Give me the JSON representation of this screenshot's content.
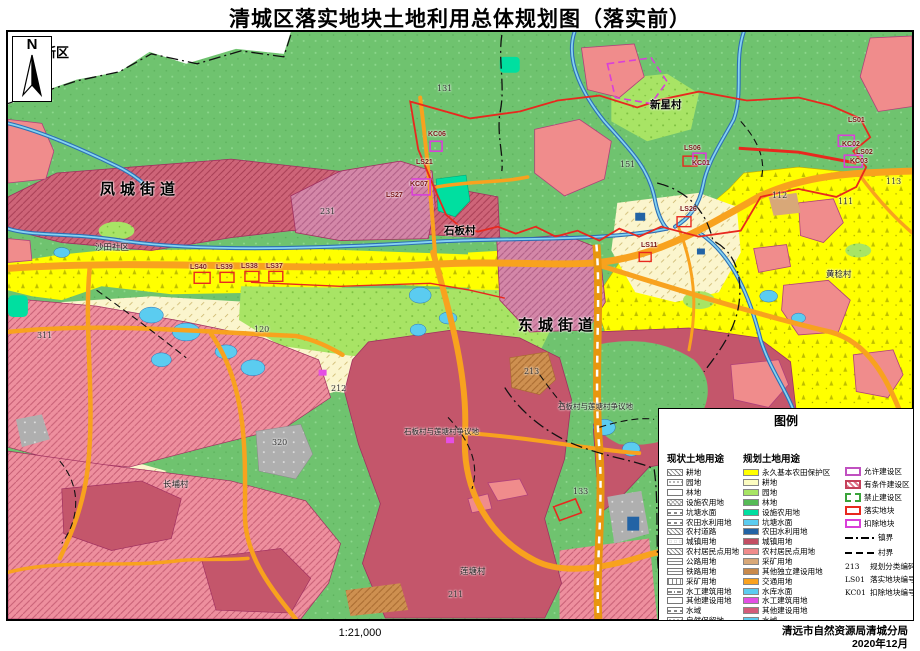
{
  "title": "清城区落实地块土地利用总体规划图（落实前）",
  "north_label": "N",
  "map": {
    "region_labels": [
      {
        "text": "清新区",
        "x": 30,
        "y": 42,
        "kind": "lbl-district"
      },
      {
        "text": "凤城街道",
        "x": 100,
        "y": 178,
        "kind": "lbl-street"
      },
      {
        "text": "东城街道",
        "x": 518,
        "y": 314,
        "kind": "lbl-street"
      },
      {
        "text": "新星村",
        "x": 650,
        "y": 97,
        "kind": "lbl-village"
      },
      {
        "text": "石板村",
        "x": 444,
        "y": 223,
        "kind": "lbl-village"
      },
      {
        "text": "沙田社区",
        "x": 95,
        "y": 241,
        "kind": "lbl-small"
      },
      {
        "text": "黄稔村",
        "x": 826,
        "y": 268,
        "kind": "lbl-small"
      },
      {
        "text": "长埔村",
        "x": 163,
        "y": 478,
        "kind": "lbl-small"
      },
      {
        "text": "莲塘村",
        "x": 460,
        "y": 565,
        "kind": "lbl-small"
      },
      {
        "text": "石板村与莲塘村争议地",
        "x": 404,
        "y": 426,
        "kind": "lbl-tiny"
      },
      {
        "text": "石板村与莲塘村争议地",
        "x": 558,
        "y": 401,
        "kind": "lbl-tiny"
      }
    ],
    "code_labels": [
      {
        "text": "131",
        "x": 437,
        "y": 84,
        "kind": "lbl-code"
      },
      {
        "text": "231",
        "x": 320,
        "y": 207,
        "kind": "lbl-code"
      },
      {
        "text": "151",
        "x": 620,
        "y": 160,
        "kind": "lbl-code"
      },
      {
        "text": "113",
        "x": 886,
        "y": 177,
        "kind": "lbl-code"
      },
      {
        "text": "112",
        "x": 772,
        "y": 191,
        "kind": "lbl-code"
      },
      {
        "text": "111",
        "x": 838,
        "y": 197,
        "kind": "lbl-code"
      },
      {
        "text": "120",
        "x": 254,
        "y": 325,
        "kind": "lbl-code"
      },
      {
        "text": "311",
        "x": 37,
        "y": 331,
        "kind": "lbl-code"
      },
      {
        "text": "212",
        "x": 331,
        "y": 384,
        "kind": "lbl-code"
      },
      {
        "text": "320",
        "x": 272,
        "y": 438,
        "kind": "lbl-code"
      },
      {
        "text": "133",
        "x": 573,
        "y": 487,
        "kind": "lbl-code"
      },
      {
        "text": "211",
        "x": 448,
        "y": 590,
        "kind": "lbl-code"
      },
      {
        "text": "213",
        "x": 524,
        "y": 367,
        "kind": "lbl-code"
      }
    ],
    "plot_labels": [
      {
        "text": "LS40",
        "x": 190,
        "y": 264,
        "kind": "lbl-plot"
      },
      {
        "text": "LS39",
        "x": 216,
        "y": 264,
        "kind": "lbl-plot"
      },
      {
        "text": "LS38",
        "x": 241,
        "y": 263,
        "kind": "lbl-plot"
      },
      {
        "text": "LS37",
        "x": 266,
        "y": 263,
        "kind": "lbl-plot"
      },
      {
        "text": "KC06",
        "x": 428,
        "y": 131,
        "kind": "lbl-plot"
      },
      {
        "text": "LS21",
        "x": 416,
        "y": 159,
        "kind": "lbl-plot"
      },
      {
        "text": "KC07",
        "x": 410,
        "y": 181,
        "kind": "lbl-plot"
      },
      {
        "text": "LS27",
        "x": 386,
        "y": 192,
        "kind": "lbl-plot"
      },
      {
        "text": "LS06",
        "x": 684,
        "y": 145,
        "kind": "lbl-plot"
      },
      {
        "text": "KC01",
        "x": 692,
        "y": 160,
        "kind": "lbl-plot"
      },
      {
        "text": "LS26",
        "x": 680,
        "y": 206,
        "kind": "lbl-plot"
      },
      {
        "text": "LS11",
        "x": 641,
        "y": 242,
        "kind": "lbl-plot"
      },
      {
        "text": "LS01",
        "x": 848,
        "y": 117,
        "kind": "lbl-plot"
      },
      {
        "text": "KC02",
        "x": 842,
        "y": 141,
        "kind": "lbl-plot"
      },
      {
        "text": "LS02",
        "x": 856,
        "y": 149,
        "kind": "lbl-plot"
      },
      {
        "text": "KC03",
        "x": 850,
        "y": 158,
        "kind": "lbl-plot"
      }
    ]
  },
  "legend": {
    "title": "图例",
    "current": {
      "title": "现状土地用途",
      "items": [
        {
          "label": "耕地",
          "pattern": "p-slash"
        },
        {
          "label": "园地",
          "pattern": "p-dots"
        },
        {
          "label": "林地",
          "pattern": "p-plain"
        },
        {
          "label": "设施农用地",
          "pattern": "p-grid"
        },
        {
          "label": "坑塘水面",
          "pattern": "p-tilde"
        },
        {
          "label": "农田水利用地",
          "pattern": "p-tilde"
        },
        {
          "label": "农村道路",
          "pattern": "p-slash"
        },
        {
          "label": "城镇用地",
          "pattern": "p-circles"
        },
        {
          "label": "农村居民点用地",
          "pattern": "p-slash"
        },
        {
          "label": "公路用地",
          "pattern": "p-hline"
        },
        {
          "label": "铁路用地",
          "pattern": "p-hline"
        },
        {
          "label": "采矿用地",
          "pattern": "p-vlines"
        },
        {
          "label": "水工建筑用地",
          "pattern": "p-dashdot"
        },
        {
          "label": "其他建设用地",
          "pattern": "p-plain"
        },
        {
          "label": "水域",
          "pattern": "p-tilde"
        },
        {
          "label": "自然保留地",
          "pattern": "p-dots"
        }
      ]
    },
    "planned": {
      "title": "规划土地用途",
      "items": [
        {
          "label": "永久基本农田保护区",
          "color": "#FFFF00"
        },
        {
          "label": "耕地",
          "color": "#FCFCC0"
        },
        {
          "label": "园地",
          "color": "#A8E465"
        },
        {
          "label": "林地",
          "color": "#56BA56"
        },
        {
          "label": "设施农用地",
          "color": "#00DFA0"
        },
        {
          "label": "坑塘水面",
          "color": "#5BCCF0"
        },
        {
          "label": "农田水利用地",
          "color": "#2263A5"
        },
        {
          "label": "城镇用地",
          "color": "#C24E63"
        },
        {
          "label": "农村居民点用地",
          "color": "#F08C8C"
        },
        {
          "label": "采矿用地",
          "color": "#D8A878"
        },
        {
          "label": "其他独立建设用地",
          "color": "#C98A4B"
        },
        {
          "label": "交通用地",
          "color": "#FAA21E"
        },
        {
          "label": "水库水面",
          "color": "#5BCCF0"
        },
        {
          "label": "水工建筑用地",
          "color": "#E44FE4"
        },
        {
          "label": "其他建设用地",
          "color": "#D45C7A"
        },
        {
          "label": "水域",
          "color": "#5BCCF0"
        },
        {
          "label": "自然保留地",
          "color": "#ABABAB"
        }
      ]
    },
    "zones": [
      {
        "label": "允许建设区",
        "pattern": "z-allow"
      },
      {
        "label": "有条件建设区",
        "pattern": "z-cond"
      },
      {
        "label": "禁止建设区",
        "pattern": "z-forb"
      },
      {
        "label": "落实地块",
        "pattern": "z-impl"
      },
      {
        "label": "扣除地块",
        "pattern": "z-ded"
      }
    ],
    "lines": [
      {
        "label": "镇界",
        "pattern": "ln-town"
      },
      {
        "label": "村界",
        "pattern": "ln-vill"
      }
    ],
    "codes": [
      {
        "code": "213",
        "label": "规划分类编码"
      },
      {
        "code": "LS01",
        "label": "落实地块编号"
      },
      {
        "code": "KC01",
        "label": "扣除地块编号"
      }
    ]
  },
  "footer": {
    "scale": "1:21,000",
    "agency": "清远市自然资源局清城分局",
    "date": "2020年12月"
  }
}
